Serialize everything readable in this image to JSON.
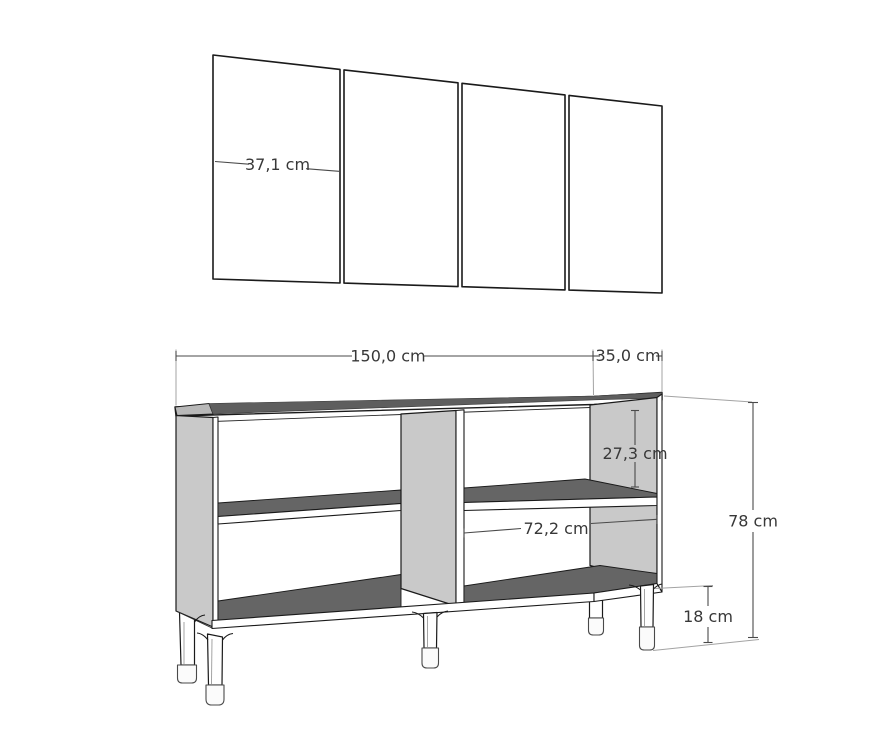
{
  "palette": {
    "background": "#ffffff",
    "outline": "#1a1a1a",
    "side_panel_gray": "#c9c9c9",
    "surface_dark_gray": "#656565",
    "top_band_gray": "#5e5e5e",
    "dimension_line": "#4a4a4a",
    "extension_line": "#a3a3a3",
    "label_color": "#383838"
  },
  "doors": {
    "count": 4,
    "door_width": {
      "label": "37,1 cm"
    }
  },
  "cabinet": {
    "width": {
      "label": "150,0 cm"
    },
    "depth": {
      "label": "35,0 cm"
    },
    "shelf_gap": {
      "label": "27,3 cm"
    },
    "compartment_width": {
      "label": "72,2 cm"
    },
    "height": {
      "label": "78 cm"
    },
    "leg_height": {
      "label": "18 cm"
    }
  }
}
